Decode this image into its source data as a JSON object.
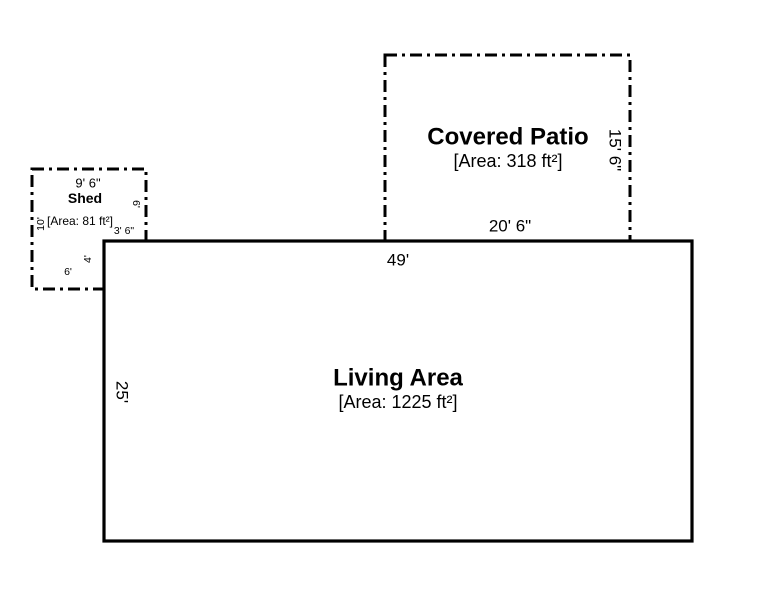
{
  "plan": {
    "living": {
      "name": "Living Area",
      "area": "[Area: 1225 ft²]",
      "width_dim": "49'",
      "height_dim": "25'"
    },
    "patio": {
      "name": "Covered Patio",
      "area": "[Area: 318 ft²]",
      "width_dim": "20' 6\"",
      "height_dim": "15' 6\""
    },
    "shed": {
      "name": "Shed",
      "area": "[Area: 81 ft²]",
      "top_dim": "9' 6\"",
      "left_dim": "10'",
      "right_dim": "6'",
      "step_h_dim": "3' 6\"",
      "step_v_dim": "4'",
      "bottom_dim": "6'"
    },
    "colors": {
      "line": "#000000",
      "background": "#ffffff"
    }
  }
}
